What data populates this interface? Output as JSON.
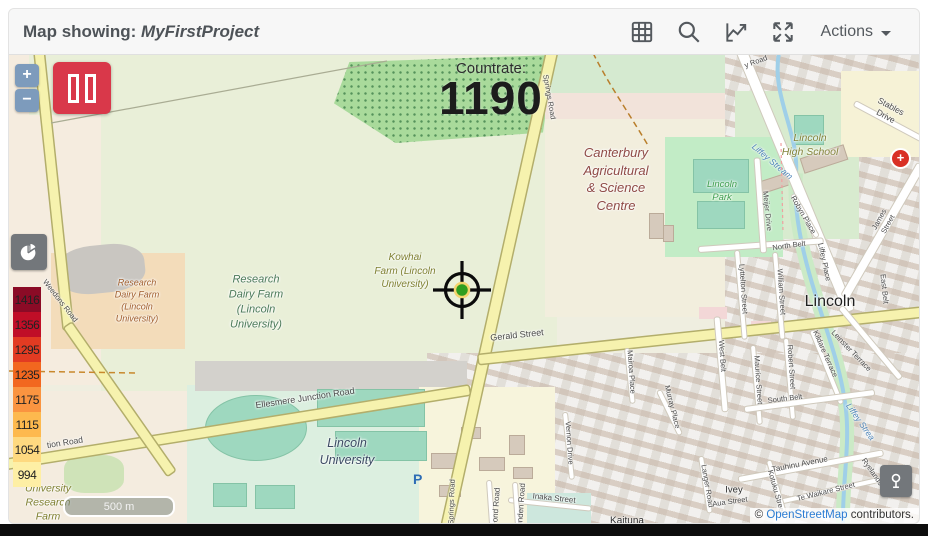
{
  "header": {
    "title_prefix": "Map showing: ",
    "project_name": "MyFirstProject",
    "actions_label": "Actions"
  },
  "map_overlay": {
    "countrate_label": "Countrate:",
    "countrate_value": "1190",
    "zoom_in": "+",
    "zoom_out": "−",
    "scale_label": "500 m",
    "parking_label": "P",
    "plus_marker": "+"
  },
  "legend": {
    "bands": [
      {
        "value": "1416",
        "color": "#8b0b26"
      },
      {
        "value": "1356",
        "color": "#c00e27"
      },
      {
        "value": "1295",
        "color": "#e23b22"
      },
      {
        "value": "1235",
        "color": "#f2671f"
      },
      {
        "value": "1175",
        "color": "#fa9440"
      },
      {
        "value": "1115",
        "color": "#fdb94e"
      },
      {
        "value": "1054",
        "color": "#fed980"
      },
      {
        "value": "994",
        "color": "#feefa5"
      }
    ]
  },
  "attribution": {
    "prefix": "© ",
    "link": "OpenStreetMap",
    "suffix": " contributors."
  },
  "colors": {
    "pause_button": "#d9384a",
    "zoom_button": "#7d9bbc",
    "control_gray": "#73777b",
    "link_blue": "#2b7cd3",
    "marker_red": "#d93025"
  },
  "map_labels": [
    {
      "t": "Research\nDairy Farm\n(Lincoln\nUniversity)",
      "x": 128,
      "y": 246,
      "s": 9,
      "c": "#a05d2c",
      "i": 1
    },
    {
      "t": "Research\nDairy Farm\n(Lincoln\nUniversity)",
      "x": 247,
      "y": 247,
      "s": 11,
      "c": "#4c7a5a",
      "i": 1
    },
    {
      "t": "Kowhai\nFarm (Lincoln\nUniversity)",
      "x": 396,
      "y": 216,
      "s": 10,
      "c": "#7f8031",
      "i": 1
    },
    {
      "t": "Canterbury\nAgricultural\n& Science\nCentre",
      "x": 607,
      "y": 124,
      "s": 13,
      "c": "#8f4a46",
      "i": 1
    },
    {
      "t": "Lincoln\nPark",
      "x": 713,
      "y": 137,
      "s": 9.5,
      "c": "#3f9e4f",
      "i": 1
    },
    {
      "t": "Lincoln\nHigh School",
      "x": 801,
      "y": 90,
      "s": 10.5,
      "c": "#84843b",
      "i": 1
    },
    {
      "t": "Lincoln",
      "x": 821,
      "y": 247,
      "s": 16,
      "c": "#1f1f1f"
    },
    {
      "t": "Lincoln\nUniversity",
      "x": 338,
      "y": 397,
      "s": 12.5,
      "c": "#3c4a63",
      "i": 1
    },
    {
      "t": "University\nResearch\nFarm",
      "x": 39,
      "y": 448,
      "s": 10.5,
      "c": "#7f8031",
      "i": 1
    },
    {
      "t": "Kaituna",
      "x": 618,
      "y": 466,
      "s": 10,
      "c": "#2e2e2e"
    },
    {
      "t": "Ivey",
      "x": 725,
      "y": 436,
      "s": 9.5,
      "c": "#2e2e2e"
    },
    {
      "t": "Weedons Road",
      "x": 51,
      "y": 246,
      "r": 52
    },
    {
      "t": "Springs Road",
      "x": 540,
      "y": 42,
      "r": 80
    },
    {
      "t": "Springs Road",
      "x": 443,
      "y": 447,
      "r": -88
    },
    {
      "t": "Gerald Street",
      "x": 508,
      "y": 280,
      "r": -6,
      "s": 9
    },
    {
      "t": "Ellesmere Junction Road",
      "x": 296,
      "y": 343,
      "r": -8.5,
      "s": 9
    },
    {
      "t": "tion Road",
      "x": 56,
      "y": 388,
      "r": -9,
      "s": 8.5
    },
    {
      "t": "y Road",
      "x": 747,
      "y": 7,
      "r": -20
    },
    {
      "t": "Stables Drive",
      "x": 879,
      "y": 57,
      "r": 28,
      "s": 8.5
    },
    {
      "t": "Robyn Place",
      "x": 794,
      "y": 160,
      "r": 60
    },
    {
      "t": "North Belt",
      "x": 780,
      "y": 191,
      "r": -8
    },
    {
      "t": "Meijer Drive",
      "x": 758,
      "y": 156,
      "r": 84
    },
    {
      "t": "Lyttelton Street",
      "x": 734,
      "y": 234,
      "r": 86
    },
    {
      "t": "William Street",
      "x": 772,
      "y": 237,
      "r": 86
    },
    {
      "t": "James Street",
      "x": 875,
      "y": 167,
      "r": -61
    },
    {
      "t": "East Belt",
      "x": 875,
      "y": 234,
      "r": 84
    },
    {
      "t": "Liffey Place",
      "x": 815,
      "y": 207,
      "r": 78
    },
    {
      "t": "West Belt",
      "x": 713,
      "y": 301,
      "r": 86
    },
    {
      "t": "Maurice Street",
      "x": 749,
      "y": 325,
      "r": 86
    },
    {
      "t": "Robert Street",
      "x": 782,
      "y": 312,
      "r": 86
    },
    {
      "t": "Kildare Terrace",
      "x": 816,
      "y": 299,
      "r": 66
    },
    {
      "t": "Leinster Terrace",
      "x": 842,
      "y": 296,
      "r": 46
    },
    {
      "t": "South Belt",
      "x": 776,
      "y": 344,
      "r": -7
    },
    {
      "t": "Murray Place",
      "x": 663,
      "y": 352,
      "r": 76
    },
    {
      "t": "Mairoa Place",
      "x": 622,
      "y": 317,
      "r": 86
    },
    {
      "t": "Vernon Drive",
      "x": 560,
      "y": 388,
      "r": 86
    },
    {
      "t": "Tauhinu Avenue",
      "x": 791,
      "y": 410,
      "r": -11,
      "s": 8
    },
    {
      "t": "Te Waikare Street",
      "x": 817,
      "y": 437,
      "r": -14
    },
    {
      "t": "Inaka Street",
      "x": 545,
      "y": 444,
      "r": 6,
      "s": 8
    },
    {
      "t": "Langer Road",
      "x": 698,
      "y": 431,
      "r": 80
    },
    {
      "t": "Kotuku Street",
      "x": 767,
      "y": 437,
      "r": 74
    },
    {
      "t": "Aua Street",
      "x": 721,
      "y": 447,
      "r": -8
    },
    {
      "t": "Ryelands",
      "x": 863,
      "y": 417,
      "r": 55
    },
    {
      "t": "ond Road",
      "x": 488,
      "y": 450,
      "r": -86,
      "s": 8
    },
    {
      "t": "unden Road",
      "x": 513,
      "y": 450,
      "r": -86,
      "s": 8
    },
    {
      "t": "Liffey Stream",
      "x": 763,
      "y": 107,
      "r": 40,
      "s": 8.5,
      "c": "#4d84b8",
      "i": 1
    },
    {
      "t": "Liffey Strea",
      "x": 851,
      "y": 367,
      "r": 55,
      "s": 8.5,
      "c": "#4d84b8",
      "i": 1
    }
  ]
}
